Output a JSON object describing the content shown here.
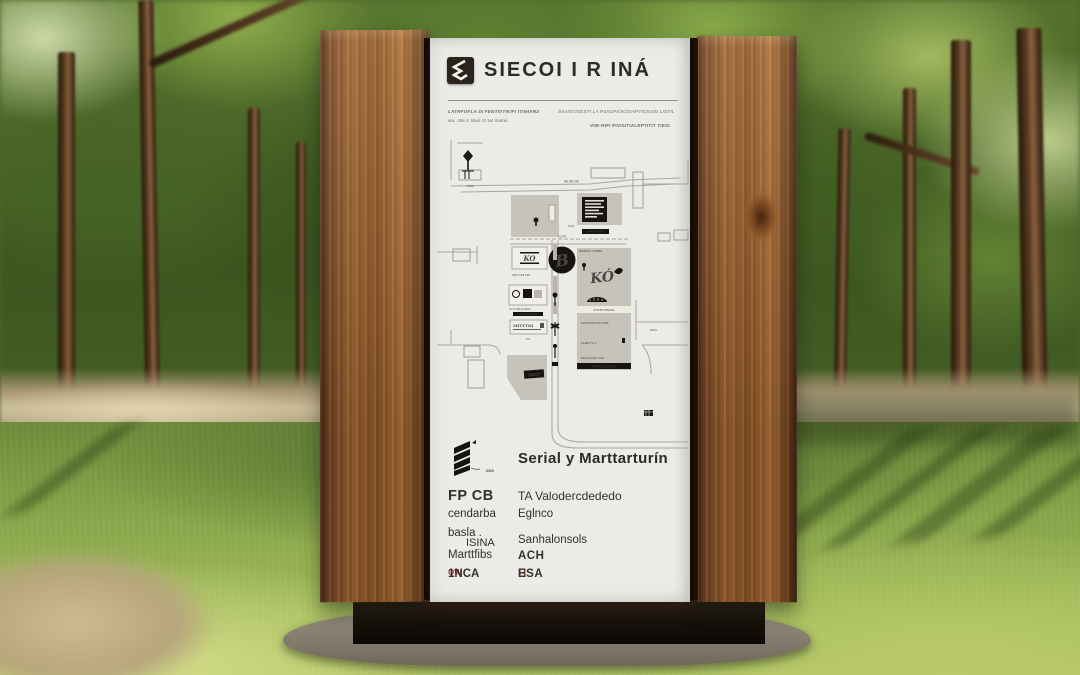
{
  "sign": {
    "brand": {
      "title": "SIECOI I R INÁ",
      "logo_icon": "angular-s-diamond"
    },
    "meta": {
      "left1": "LATRFOFLA DI FENTIVTIKIFI ITIIMAR2",
      "left2": "wa. Jits A Stuli Jt tat mwtai",
      "right1": "SIIAISTIDESTI LA PSIIGPIOIGSIAPTIGIGIID LISTIL",
      "right2": "VIIE-RIFI PIVISITIALEPTITIT TIESI"
    },
    "map": {
      "pin_label": "LINIA",
      "street_label": "SE SE DE",
      "block_label": "CI/A",
      "black_strip_top": "IMPA PICIEIGI",
      "road_label": "CLTIP",
      "ko_logo": "KO",
      "ko_caption": "CRO JUNI KIAI",
      "poi_circle_glyph": "B",
      "right_strip_top": "MOMBOLI I MIRIBA",
      "graffiti_glyph": "KÓ",
      "white_strip": "PIVILBOTOIGIDIS",
      "left_caption": "mt OY BA Lunchirc",
      "left_strip": "CACB PIGIL BIND",
      "mitt_label": "MITTTKI",
      "mitt_caption": "Tris",
      "right_row1": "CHOSTIPIOTIS TIPIS",
      "right_row2": "LILIEIKTIV 4",
      "right_row3": "MILIS RIVEY ILIAL",
      "right_strip_bottom": "PIVISILIOIGEIYIEIV",
      "small_label": "tOI/A",
      "gexx_tag": "GEXX"
    },
    "section": {
      "icon": "stacked-chevrons",
      "icon_caption": "ana",
      "heading": "Serial y Marttarturín"
    },
    "directory": {
      "left": [
        {
          "text": "FP CB"
        },
        {
          "text": "cendarba"
        },
        {
          "text": "basla ."
        },
        {
          "text": "ISINA"
        },
        {
          "text": "Marttfibs"
        },
        {
          "prefix": "QW",
          "text": "1NCA"
        }
      ],
      "right": [
        {
          "text": "TA Valodercdededo"
        },
        {
          "text": "Eglnco"
        },
        {
          "text": "Sanhalonsols"
        },
        {
          "text": "ACH"
        },
        {
          "prefix": "H",
          "text": "ESA"
        }
      ]
    }
  },
  "colors": {
    "accent_red": "#a3392c",
    "panel_bg": "#ebebe8",
    "wood_mid": "#8a5425",
    "ink": "#17130e",
    "map_gray": "#c6c3bb"
  }
}
